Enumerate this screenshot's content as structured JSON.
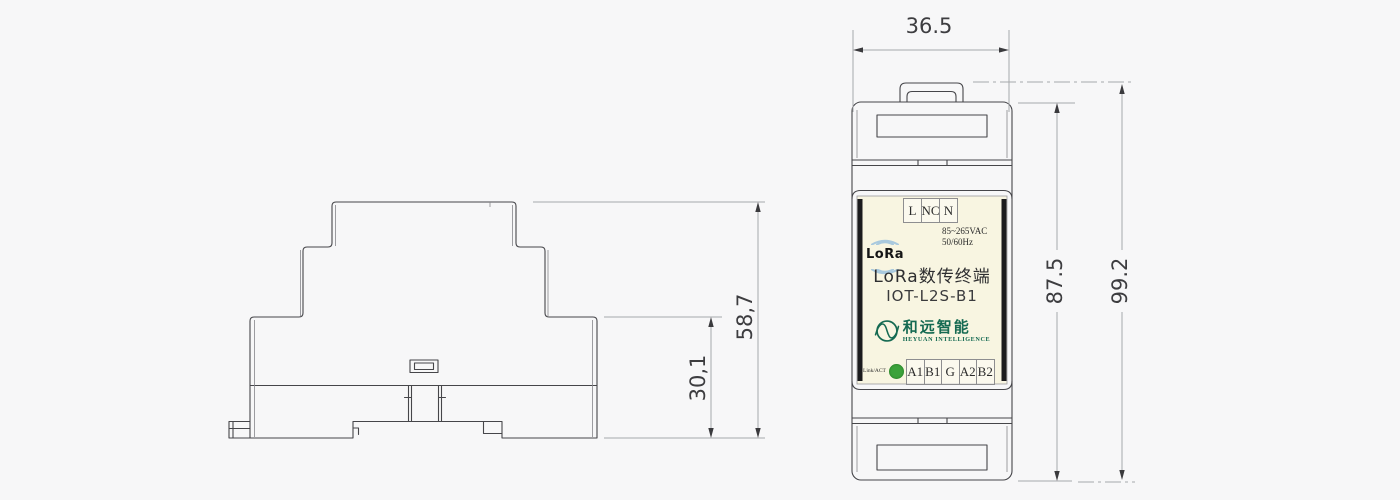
{
  "drawing": {
    "side_view": {
      "dims": {
        "overall_height": "58,7",
        "base_height": "30,1"
      }
    },
    "front_view": {
      "dims": {
        "width": "36.5",
        "body_height": "87.5",
        "overall_height": "99.2"
      },
      "panel_label": {
        "terminals_top": [
          "L",
          "NC",
          "N"
        ],
        "voltage": "85~265VAC",
        "frequency": "50/60Hz",
        "radio": "LoRa",
        "title": "LoRa数传终端",
        "model": "IOT-L2S-B1",
        "brand_cn": "和远智能",
        "brand_en": "HEYUAN INTELLIGENCE",
        "led_label": "Link/ACT",
        "terminals_bottom": [
          "A1",
          "B1",
          "G",
          "A2",
          "B2"
        ]
      }
    },
    "colors": {
      "background": "#f7f7f8",
      "outline": "#46464a",
      "dimension_line": "#a6a8ab",
      "dimension_text": "#3d3d40",
      "label_background": "#f8f5e1",
      "label_side_bars": "#1b1b1d",
      "led_green": "#3ba23a",
      "brand_teal": "#156a52",
      "lora_arc_blue": "#a9c9de"
    }
  }
}
